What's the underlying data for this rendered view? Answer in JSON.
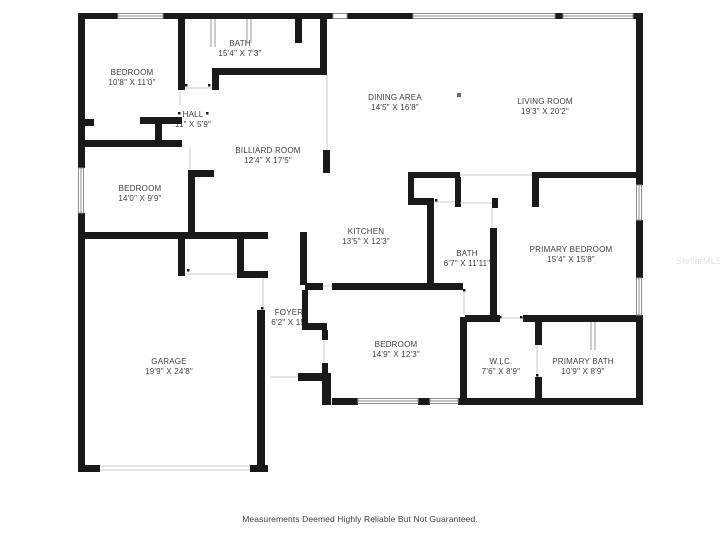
{
  "plan": {
    "disclaimer": "Measurements Deemed Highly Reliable But Not Guaranteed.",
    "watermark": "StellarMLS",
    "colors": {
      "wall": "#1a1a1a",
      "label_text": "#3d3d3d",
      "window_frame": "#8f8f8f",
      "open_boundary": "#c9c9c9",
      "background": "#ffffff",
      "watermark": "#e2e2e2"
    },
    "rooms": [
      {
        "id": "bedroom-1",
        "name": "BEDROOM",
        "dims": "10'8\" X 11'0\""
      },
      {
        "id": "bath-1",
        "name": "BATH",
        "dims": "15'4\" X 7'3\""
      },
      {
        "id": "hall",
        "name": "HALL",
        "dims": "11\" X 5'9\""
      },
      {
        "id": "dining-area",
        "name": "DINING AREA",
        "dims": "14'5\" X 16'8\""
      },
      {
        "id": "living-room",
        "name": "LIVING ROOM",
        "dims": "19'3\" X 20'2\""
      },
      {
        "id": "billiard-room",
        "name": "BILLIARD ROOM",
        "dims": "12'4\" X 17'5\""
      },
      {
        "id": "bedroom-2",
        "name": "BEDROOM",
        "dims": "14'0\" X 9'9\""
      },
      {
        "id": "kitchen",
        "name": "KITCHEN",
        "dims": "13'5\" X 12'3\""
      },
      {
        "id": "bath-2",
        "name": "BATH",
        "dims": "6'7\" X 11'11\""
      },
      {
        "id": "primary-bedroom",
        "name": "PRIMARY BEDROOM",
        "dims": "15'4\" X 15'8\""
      },
      {
        "id": "foyer",
        "name": "FOYER",
        "dims": "6'2\" X 15'"
      },
      {
        "id": "bedroom-3",
        "name": "BEDROOM",
        "dims": "14'9\" X 12'3\""
      },
      {
        "id": "garage",
        "name": "GARAGE",
        "dims": "19'9\" X 24'8\""
      },
      {
        "id": "wic",
        "name": "W.I.C.",
        "dims": "7'6\" X 8'9\""
      },
      {
        "id": "primary-bath",
        "name": "PRIMARY BATH",
        "dims": "10'9\" X 8'9\""
      }
    ]
  }
}
